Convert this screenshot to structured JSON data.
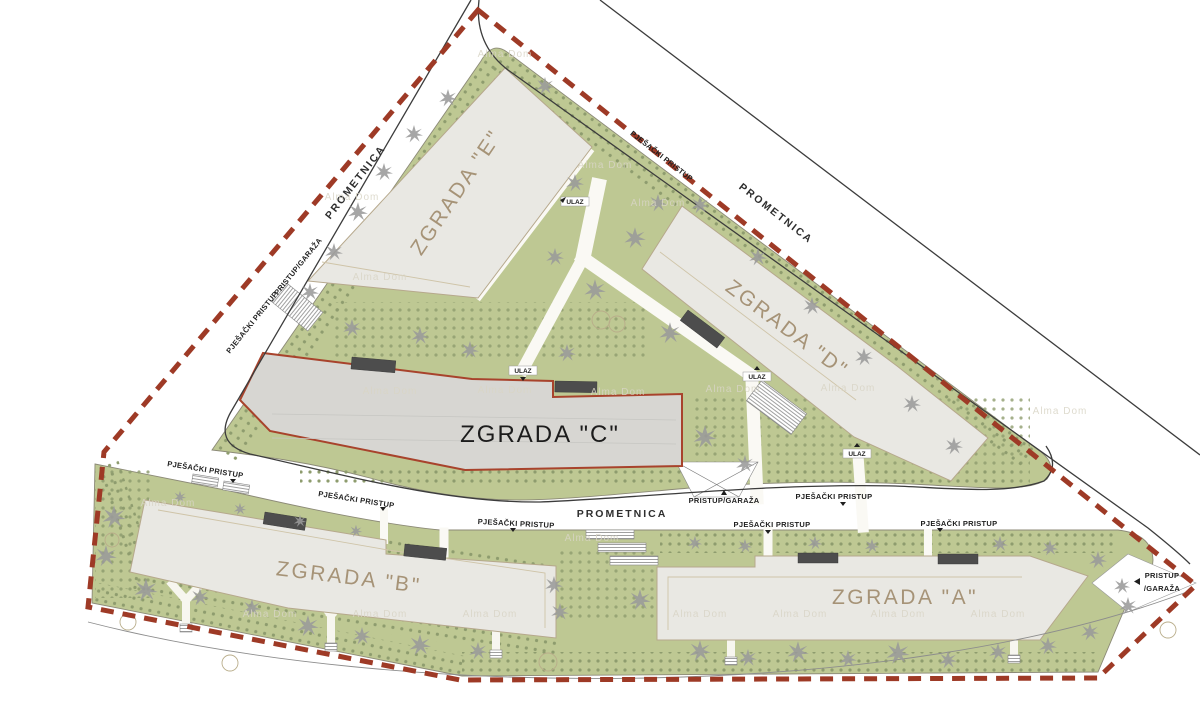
{
  "plan": {
    "buildings": {
      "a": "ZGRADA \"A\"",
      "b": "ZGRADA \"B\"",
      "c": "ZGRADA \"C\"",
      "d": "ZGRADA \"D\"",
      "e": "ZGRADA \"E\""
    },
    "roads": {
      "prometnica": "PROMETNICA"
    },
    "access": {
      "pedestrian": "PJEŠAČKI PRISTUP",
      "entrance": "ULAZ",
      "garage": "PRISTUP/GARAŽA",
      "garage_line1": "PRISTUP",
      "garage_line2": "/GARAŽA"
    },
    "watermark": "Alma Dom",
    "colors": {
      "lawn": "#bec893",
      "building": "#e9e8e3",
      "building_c": "#d7d6d2",
      "boundary": "#9e3a26",
      "canopy": "#4d4d4d",
      "tree": "#9a9a9a",
      "label_brown": "#a69377",
      "road_line": "#3c3c3c"
    }
  }
}
